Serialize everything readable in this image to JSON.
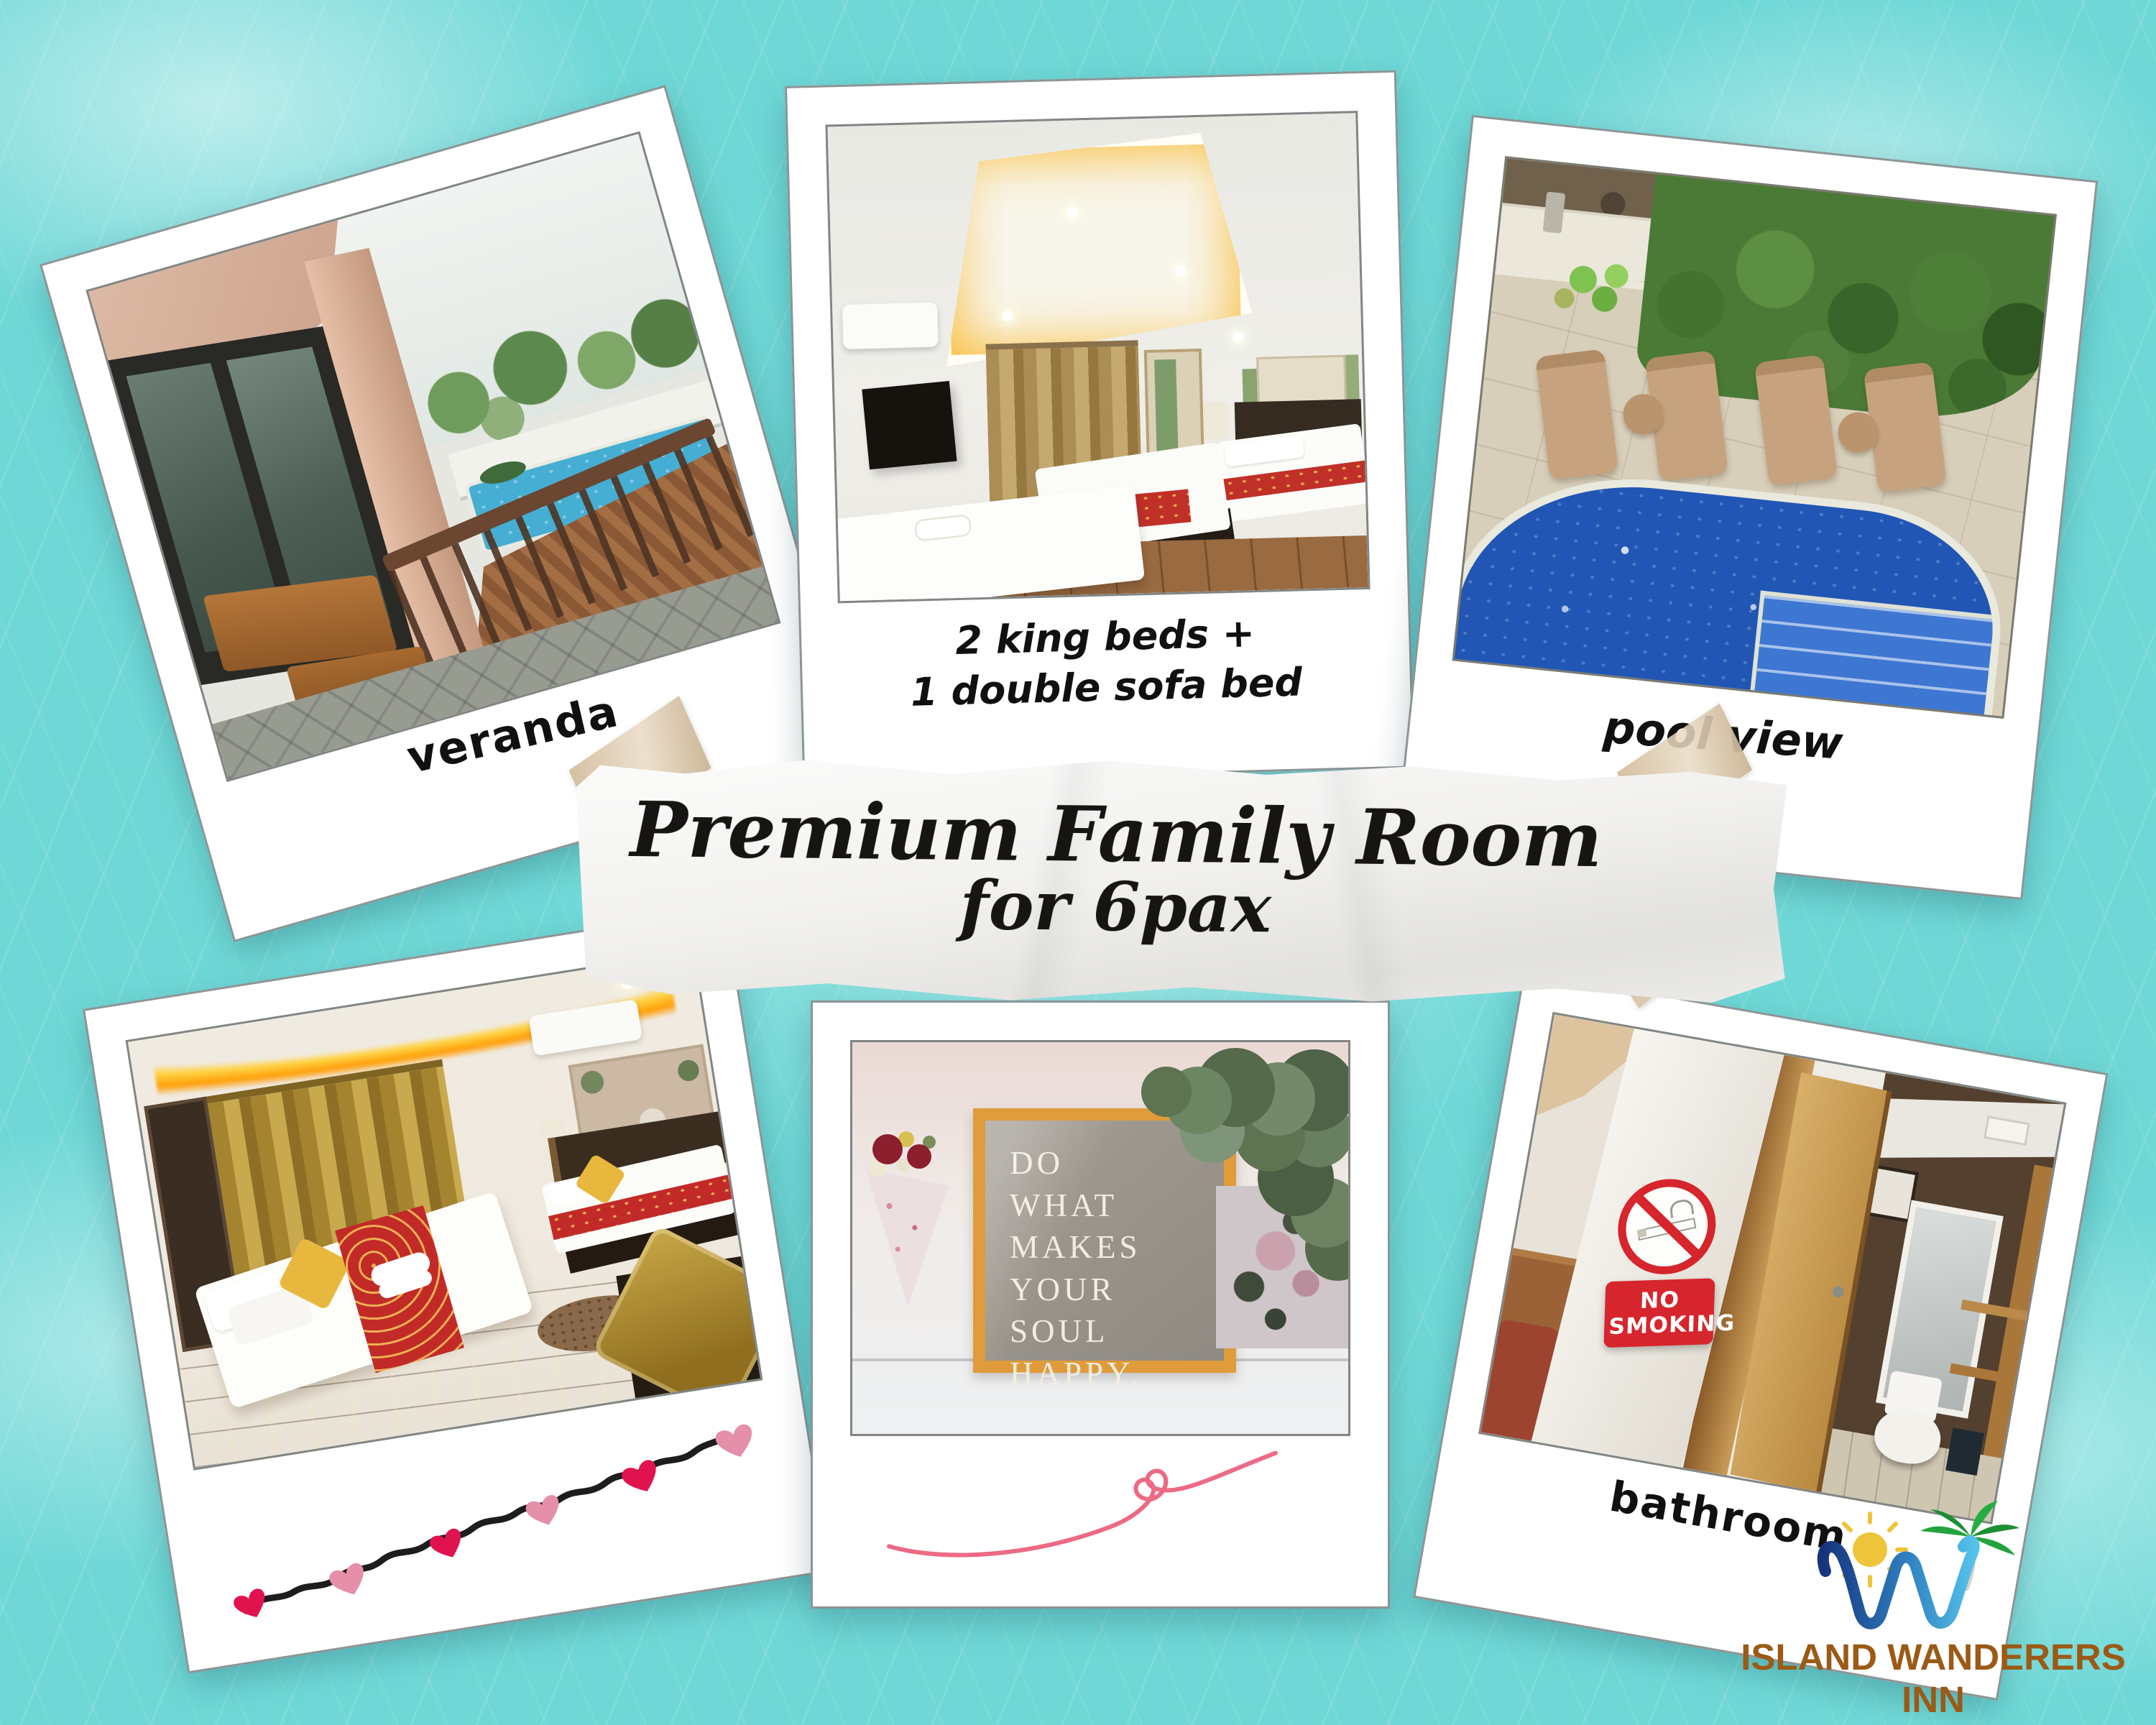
{
  "banner": {
    "line1": "Premium Family Room",
    "line2": "for 6pax"
  },
  "polaroids": {
    "veranda": {
      "caption": "veranda"
    },
    "bedroom_main": {
      "caption": "2 king beds +\n1 double sofa bed"
    },
    "pool": {
      "caption": "pool view"
    },
    "wall_art": {
      "quote": "DO\nWHAT\nMAKES\nYOUR\nSOUL\nHAPPY."
    },
    "bathroom": {
      "caption": "bathroom",
      "sign": "NO\nSMOKING"
    }
  },
  "logo": {
    "name": "ISLAND WANDERERS INN",
    "location": "CORON, PALAWAN"
  },
  "colors": {
    "water": "#6fd8d7",
    "banner_paper": "#f1f0ee",
    "title_text": "#171513",
    "logo_name": "#9b5a15",
    "logo_location": "#8d8d8d",
    "heart_dark": "#e0134f",
    "heart_light": "#e58fa8",
    "tape": "#d8c3a4",
    "no_smoking_red": "#d6252c",
    "frame_orange": "#e09b3a"
  },
  "icons": {
    "sun": "sun-icon",
    "palm": "palm-tree-icon",
    "monogram": "w-monogram-icon",
    "hearts": "hearts-garland",
    "squiggle": "heart-squiggle",
    "tape": "tape-strip",
    "no_smoking": "no-smoking-sign"
  }
}
